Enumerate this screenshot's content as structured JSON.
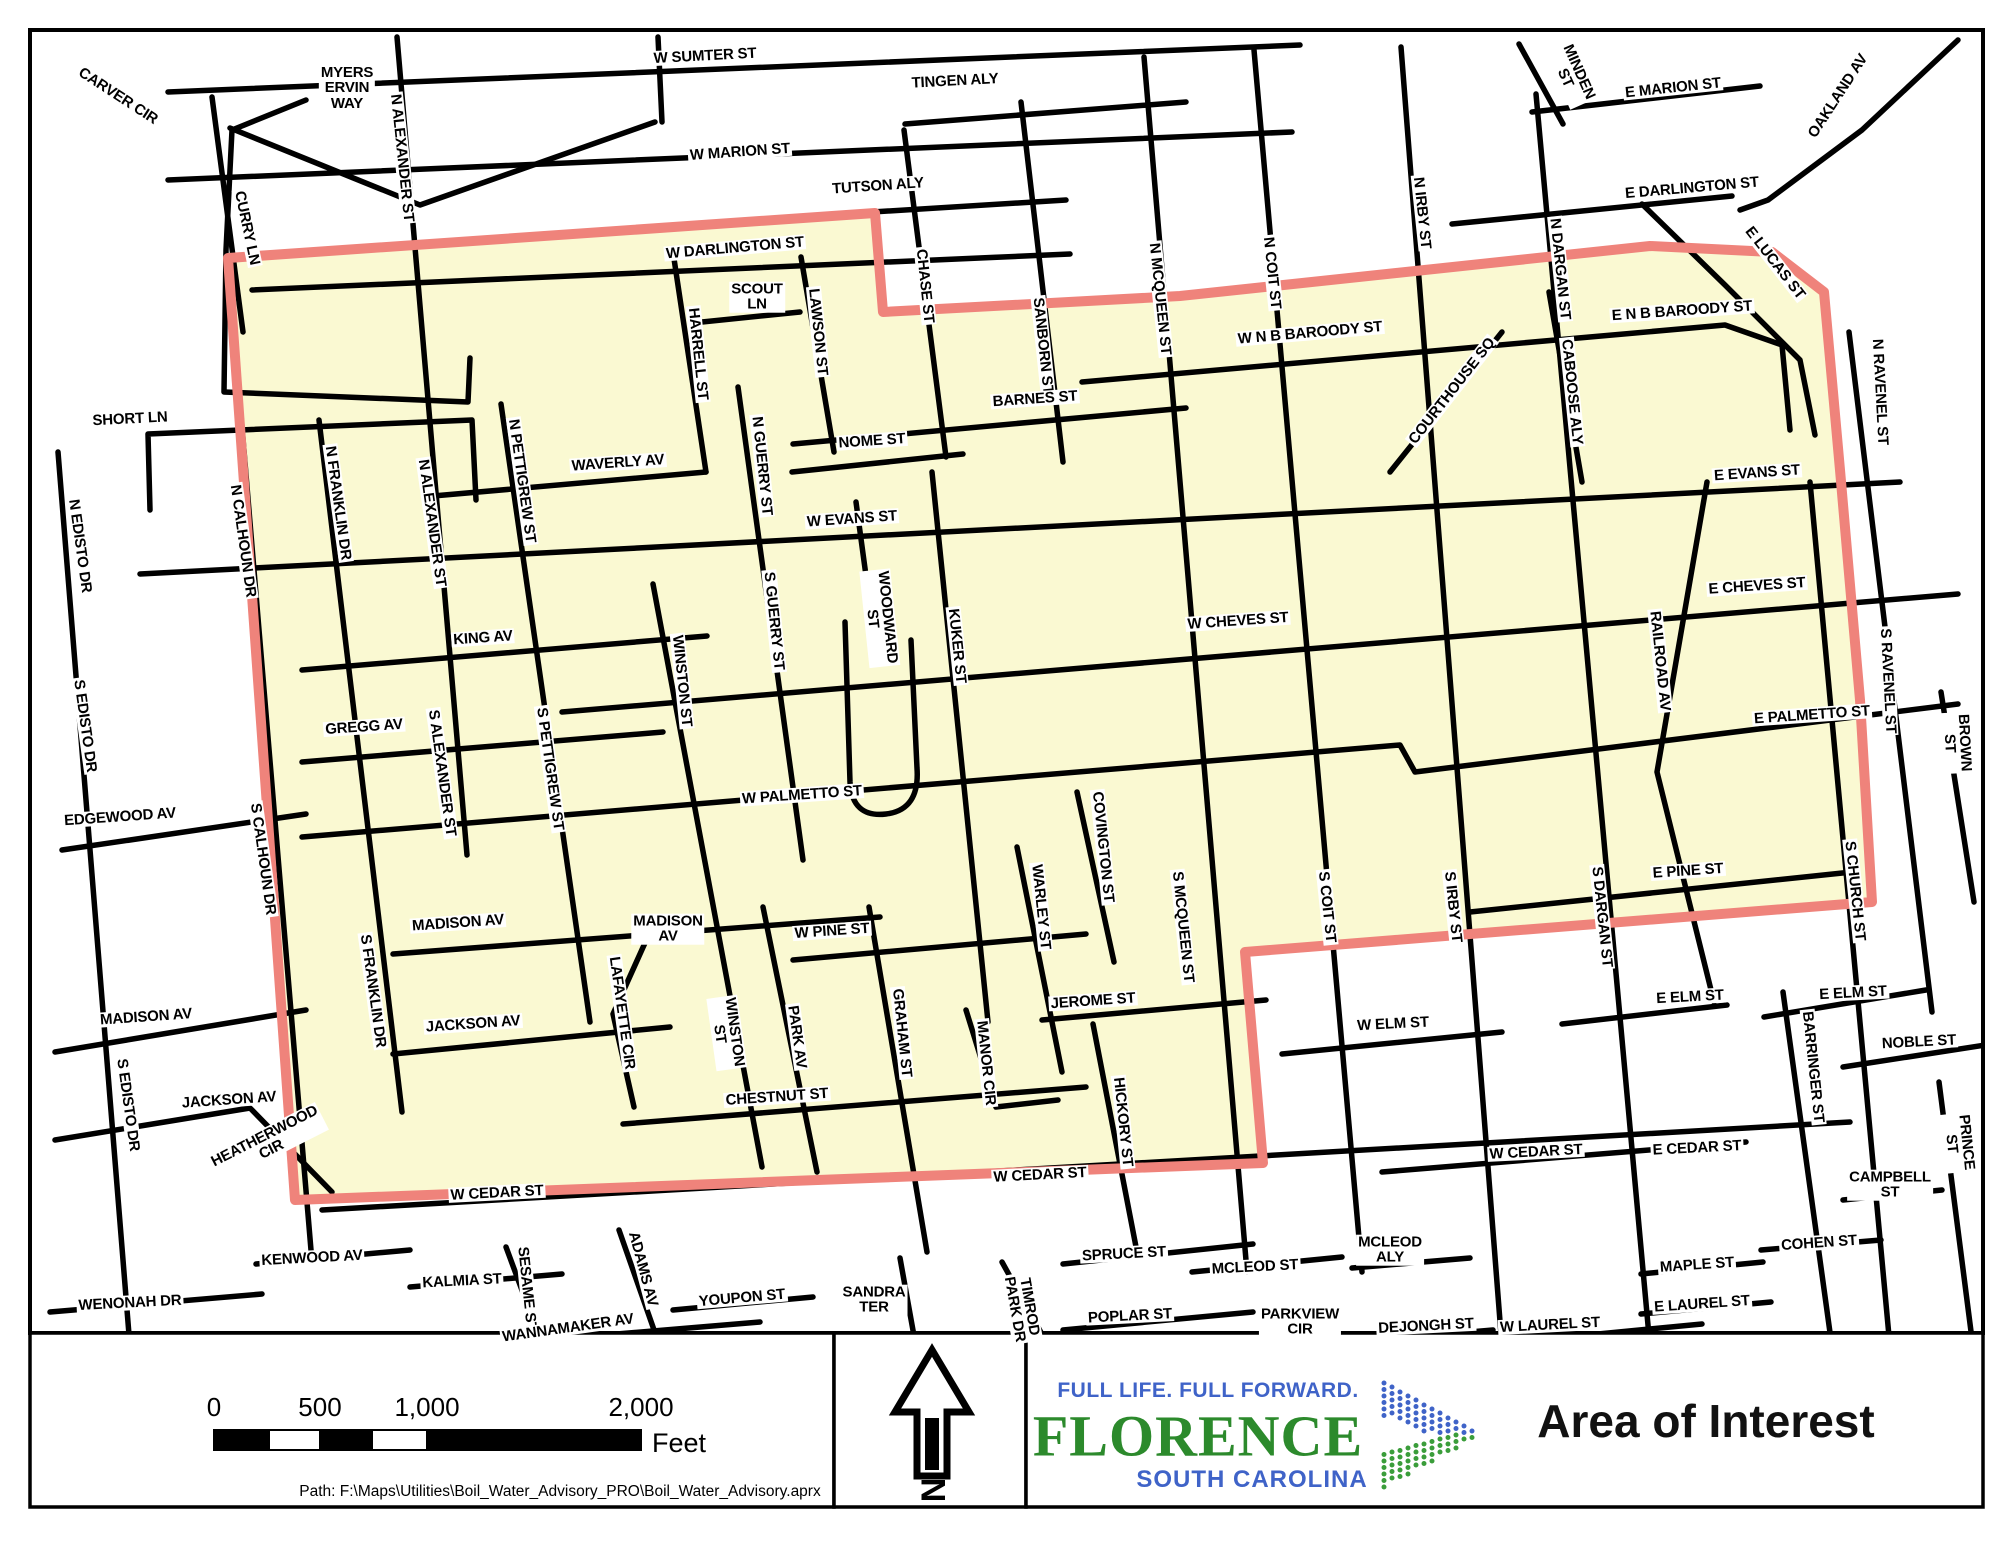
{
  "map": {
    "colors": {
      "road": "#000000",
      "area_fill": "#FAF9D2",
      "boundary": "#EF837B",
      "frame": "#000000"
    },
    "area_points": "228,258 875,213 883,312 1180,296 1650,246 1772,252 1824,292 1840,470 1860,700 1872,902 1245,952 1263,1163 295,1200",
    "roads": [
      {
        "p": "168,92 1300,45"
      },
      {
        "p": "168,180 1292,132"
      },
      {
        "p": "905,124 1186,102"
      },
      {
        "p": "792,217 1066,200"
      },
      {
        "p": "252,290 1070,254"
      },
      {
        "p": "1452,224 1732,196"
      },
      {
        "p": "1532,112 1760,86"
      },
      {
        "p": "1519,44 1563,124"
      },
      {
        "p": "1958,40 1862,130 1768,200 1740,210"
      },
      {
        "p": "1642,204 1725,285 1800,360 1815,435"
      },
      {
        "p": "1082,382 1725,325 1782,345 1790,430"
      },
      {
        "p": "793,444 1186,408"
      },
      {
        "p": "792,472 963,454"
      },
      {
        "p": "433,496 706,472"
      },
      {
        "p": "140,574 1900,482"
      },
      {
        "p": "302,670 707,636"
      },
      {
        "p": "562,712 1958,594"
      },
      {
        "p": "302,762 663,732"
      },
      {
        "p": "302,837 1400,745 1415,772 1958,704"
      },
      {
        "p": "393,954 880,917"
      },
      {
        "p": "393,1054 670,1027"
      },
      {
        "p": "793,960 1086,934"
      },
      {
        "p": "1042,1020 1266,1000"
      },
      {
        "p": "623,1124 1086,1087"
      },
      {
        "p": "322,1210 1850,1122"
      },
      {
        "p": "1282,1054 1502,1032"
      },
      {
        "p": "1562,1024 1727,1005"
      },
      {
        "p": "1764,1017 1926,990"
      },
      {
        "p": "1843,1067 1992,1044"
      },
      {
        "p": "1470,912 1852,872"
      },
      {
        "p": "1382,1172 1746,1142"
      },
      {
        "p": "62,850 306,814"
      },
      {
        "p": "55,1052 306,1010"
      },
      {
        "p": "55,1140 250,1108 332,1192"
      },
      {
        "p": "50,1312 262,1294"
      },
      {
        "p": "256,1264 410,1250"
      },
      {
        "p": "410,1287 562,1274"
      },
      {
        "p": "462,1347 760,1322"
      },
      {
        "p": "673,1310 813,1297"
      },
      {
        "p": "1063,1264 1253,1244"
      },
      {
        "p": "1063,1330 1253,1312"
      },
      {
        "p": "1192,1272 1342,1257"
      },
      {
        "p": "1352,1268 1470,1258"
      },
      {
        "p": "1463,1347 1702,1324"
      },
      {
        "p": "1641,1314 1771,1302"
      },
      {
        "p": "1641,1274 1763,1262"
      },
      {
        "p": "1761,1250 1881,1240"
      },
      {
        "p": "1352,1342 1493,1330"
      },
      {
        "p": "1843,1200 1942,1190"
      },
      {
        "p": "702,322 800,312"
      },
      {
        "p": "397,37 467,855"
      },
      {
        "p": "658,37 662,122"
      },
      {
        "p": "230,128 420,205 655,122"
      },
      {
        "p": "212,97 243,332"
      },
      {
        "p": "228,260 312,1262"
      },
      {
        "p": "673,252 706,472"
      },
      {
        "p": "801,257 834,452"
      },
      {
        "p": "904,130 946,457"
      },
      {
        "p": "1021,102 1063,462"
      },
      {
        "p": "1144,57 1247,1272"
      },
      {
        "p": "1254,50 1362,1272"
      },
      {
        "p": "1401,47 1502,1347"
      },
      {
        "p": "1536,94 1650,1347"
      },
      {
        "p": "1549,292 1582,482"
      },
      {
        "p": "1390,472 1502,332"
      },
      {
        "p": "738,387 803,860"
      },
      {
        "p": "856,502 872,620"
      },
      {
        "p": "932,472 988,1022"
      },
      {
        "p": "653,584 762,1167"
      },
      {
        "p": "1077,792 1114,962"
      },
      {
        "p": "1017,847 1062,1072"
      },
      {
        "p": "1707,482 1657,772 1714,1002"
      },
      {
        "p": "1810,482 1890,1347"
      },
      {
        "p": "1849,332 1932,1012"
      },
      {
        "p": "1941,692 1974,902"
      },
      {
        "p": "1783,992 1832,1347"
      },
      {
        "p": "1939,1082 1973,1347"
      },
      {
        "p": "319,420 402,1112"
      },
      {
        "p": "501,404 590,1022"
      },
      {
        "p": "649,934 613,1014 634,1107"
      },
      {
        "p": "763,907 817,1172"
      },
      {
        "p": "869,907 927,1252"
      },
      {
        "p": "966,1010 996,1107 1058,1100"
      },
      {
        "p": "1093,1024 1137,1252"
      },
      {
        "p": "58,452 130,1347"
      },
      {
        "p": "619,1230 660,1347"
      },
      {
        "p": "506,1247 543,1347"
      },
      {
        "p": "1002,1262 1049,1347"
      },
      {
        "p": "900,1258 916,1347"
      },
      {
        "p": "150,510 148,434 472,420 476,500"
      },
      {
        "p": "306,100 232,130 226,250 224,392 468,402 470,358"
      },
      {
        "d": "M845,622 L850,782 Q852,818 886,814 Q920,810 917,768 L911,640"
      }
    ],
    "labels": [
      {
        "t": "CARVER CIR",
        "x": 118,
        "y": 96,
        "r": 33
      },
      {
        "t": "MYERS\nERVIN\nWAY",
        "x": 347,
        "y": 88
      },
      {
        "t": "W SUMTER ST",
        "x": 705,
        "y": 56,
        "r": -3
      },
      {
        "t": "TINGEN ALY",
        "x": 955,
        "y": 81,
        "r": -3
      },
      {
        "t": "W MARION ST",
        "x": 740,
        "y": 152,
        "r": -4
      },
      {
        "t": "TUTSON ALY",
        "x": 878,
        "y": 186,
        "r": -4
      },
      {
        "t": "N ALEXANDER ST",
        "x": 402,
        "y": 158,
        "r": 84
      },
      {
        "t": "CURRY LN",
        "x": 247,
        "y": 228,
        "r": 78
      },
      {
        "t": "MINDEN\nST",
        "x": 1572,
        "y": 75,
        "r": 66
      },
      {
        "t": "E MARION ST",
        "x": 1673,
        "y": 88,
        "r": -6
      },
      {
        "t": "OAKLAND AV",
        "x": 1838,
        "y": 96,
        "r": -57
      },
      {
        "t": "E DARLINGTON ST",
        "x": 1692,
        "y": 188,
        "r": -5
      },
      {
        "t": "E LUCAS ST",
        "x": 1775,
        "y": 263,
        "r": 52
      },
      {
        "t": "N RAVENEL ST",
        "x": 1880,
        "y": 392,
        "r": 87
      },
      {
        "t": "W DARLINGTON ST",
        "x": 735,
        "y": 248,
        "r": -5
      },
      {
        "t": "SCOUT\nLN",
        "x": 757,
        "y": 297
      },
      {
        "t": "CHASE ST",
        "x": 925,
        "y": 286,
        "r": 84
      },
      {
        "t": "LAWSON ST",
        "x": 818,
        "y": 332,
        "r": 84
      },
      {
        "t": "SANBORN ST",
        "x": 1043,
        "y": 346,
        "r": 84
      },
      {
        "t": "N MCQUEEN ST",
        "x": 1160,
        "y": 299,
        "r": 84
      },
      {
        "t": "N COIT ST",
        "x": 1272,
        "y": 273,
        "r": 84
      },
      {
        "t": "N IRBY ST",
        "x": 1422,
        "y": 213,
        "r": 84
      },
      {
        "t": "W N B BAROODY ST",
        "x": 1310,
        "y": 333,
        "r": -5
      },
      {
        "t": "E N B BAROODY ST",
        "x": 1682,
        "y": 311,
        "r": -4
      },
      {
        "t": "COURTHOUSE SQ",
        "x": 1452,
        "y": 391,
        "r": -52
      },
      {
        "t": "N DARGAN ST",
        "x": 1560,
        "y": 269,
        "r": 84
      },
      {
        "t": "CABOOSE ALY",
        "x": 1572,
        "y": 392,
        "r": 84
      },
      {
        "t": "BARNES ST",
        "x": 1035,
        "y": 399,
        "r": -4
      },
      {
        "t": "HARRELL ST",
        "x": 698,
        "y": 354,
        "r": 84
      },
      {
        "t": "NOME ST",
        "x": 872,
        "y": 441,
        "r": -4
      },
      {
        "t": "N GUERRY ST",
        "x": 762,
        "y": 466,
        "r": 84
      },
      {
        "t": "WAVERLY AV",
        "x": 618,
        "y": 463,
        "r": -4
      },
      {
        "t": "W EVANS ST",
        "x": 852,
        "y": 519,
        "r": -4
      },
      {
        "t": "E EVANS ST",
        "x": 1757,
        "y": 473,
        "r": -4
      },
      {
        "t": "SHORT LN",
        "x": 130,
        "y": 419,
        "r": -3
      },
      {
        "t": "N EDISTO DR",
        "x": 80,
        "y": 546,
        "r": 82
      },
      {
        "t": "N CALHOUN DR",
        "x": 243,
        "y": 541,
        "r": 82
      },
      {
        "t": "N FRANKLIN DR",
        "x": 338,
        "y": 503,
        "r": 82
      },
      {
        "t": "N ALEXANDER ST",
        "x": 432,
        "y": 523,
        "r": 82
      },
      {
        "t": "N PETTIGREW ST",
        "x": 522,
        "y": 481,
        "r": 82
      },
      {
        "t": "S GUERRY ST",
        "x": 774,
        "y": 621,
        "r": 84
      },
      {
        "t": "WOODWARD\nST",
        "x": 880,
        "y": 618,
        "r": 84
      },
      {
        "t": "KUKER ST",
        "x": 957,
        "y": 646,
        "r": 84
      },
      {
        "t": "W CHEVES ST",
        "x": 1238,
        "y": 621,
        "r": -4
      },
      {
        "t": "E CHEVES ST",
        "x": 1757,
        "y": 586,
        "r": -4
      },
      {
        "t": "KING AV",
        "x": 483,
        "y": 638,
        "r": -4
      },
      {
        "t": "WINSTON ST",
        "x": 682,
        "y": 681,
        "r": 84
      },
      {
        "t": "RAILROAD AV",
        "x": 1660,
        "y": 661,
        "r": 84
      },
      {
        "t": "S RAVENEL ST",
        "x": 1888,
        "y": 681,
        "r": 87
      },
      {
        "t": "BROWN ST",
        "x": 1957,
        "y": 743,
        "r": 87
      },
      {
        "t": "GREGG AV",
        "x": 364,
        "y": 727,
        "r": -4
      },
      {
        "t": "S ALEXANDER ST",
        "x": 442,
        "y": 773,
        "r": 82
      },
      {
        "t": "S PETTIGREW ST",
        "x": 550,
        "y": 769,
        "r": 82
      },
      {
        "t": "S EDISTO DR",
        "x": 85,
        "y": 726,
        "r": 82
      },
      {
        "t": "S CALHOUN DR",
        "x": 263,
        "y": 859,
        "r": 82
      },
      {
        "t": "EDGEWOOD AV",
        "x": 120,
        "y": 817,
        "r": -4
      },
      {
        "t": "W PALMETTO ST",
        "x": 802,
        "y": 795,
        "r": -4
      },
      {
        "t": "E PALMETTO ST",
        "x": 1812,
        "y": 715,
        "r": -4
      },
      {
        "t": "COVINGTON ST",
        "x": 1103,
        "y": 847,
        "r": 84
      },
      {
        "t": "WARLEY ST",
        "x": 1041,
        "y": 907,
        "r": 84
      },
      {
        "t": "S MCQUEEN ST",
        "x": 1183,
        "y": 927,
        "r": 84
      },
      {
        "t": "S COIT ST",
        "x": 1327,
        "y": 907,
        "r": 84
      },
      {
        "t": "S IRBY ST",
        "x": 1453,
        "y": 907,
        "r": 84
      },
      {
        "t": "S DARGAN ST",
        "x": 1602,
        "y": 917,
        "r": 84
      },
      {
        "t": "E PINE ST",
        "x": 1688,
        "y": 871,
        "r": -4
      },
      {
        "t": "S CHURCH ST",
        "x": 1855,
        "y": 891,
        "r": 84
      },
      {
        "t": "MADISON AV",
        "x": 458,
        "y": 923,
        "r": -4
      },
      {
        "t": "MADISON\nAV",
        "x": 668,
        "y": 929
      },
      {
        "t": "W PINE ST",
        "x": 832,
        "y": 931,
        "r": -4
      },
      {
        "t": "GRAHAM ST",
        "x": 902,
        "y": 1033,
        "r": 84
      },
      {
        "t": "MANOR CIR",
        "x": 986,
        "y": 1063,
        "r": 84
      },
      {
        "t": "JEROME ST",
        "x": 1093,
        "y": 1001,
        "r": -4
      },
      {
        "t": "LAFAYETTE CIR",
        "x": 622,
        "y": 1013,
        "r": 82
      },
      {
        "t": "WINSTON\nST",
        "x": 727,
        "y": 1033,
        "r": 82
      },
      {
        "t": "PARK AV",
        "x": 797,
        "y": 1037,
        "r": 82
      },
      {
        "t": "JACKSON AV",
        "x": 473,
        "y": 1024,
        "r": -4
      },
      {
        "t": "S FRANKLIN DR",
        "x": 373,
        "y": 991,
        "r": 82
      },
      {
        "t": "MADISON AV",
        "x": 146,
        "y": 1017,
        "r": -4
      },
      {
        "t": "JACKSON AV",
        "x": 229,
        "y": 1100,
        "r": -4
      },
      {
        "t": "S EDISTO DR",
        "x": 128,
        "y": 1105,
        "r": 82
      },
      {
        "t": "HEATHERWOOD\nCIR",
        "x": 268,
        "y": 1143,
        "r": -27
      },
      {
        "t": "CHESTNUT ST",
        "x": 777,
        "y": 1097,
        "r": -4
      },
      {
        "t": "HICKORY ST",
        "x": 1123,
        "y": 1122,
        "r": 84
      },
      {
        "t": "W CEDAR ST",
        "x": 497,
        "y": 1193,
        "r": -3
      },
      {
        "t": "W CEDAR ST",
        "x": 1040,
        "y": 1175,
        "r": -3
      },
      {
        "t": "W ELM ST",
        "x": 1393,
        "y": 1024,
        "r": -3
      },
      {
        "t": "E ELM ST",
        "x": 1690,
        "y": 997,
        "r": -3
      },
      {
        "t": "E ELM ST",
        "x": 1853,
        "y": 993,
        "r": -3
      },
      {
        "t": "BARRINGER ST",
        "x": 1813,
        "y": 1067,
        "r": 84
      },
      {
        "t": "NOBLE ST",
        "x": 1919,
        "y": 1042,
        "r": -3
      },
      {
        "t": "W CEDAR ST",
        "x": 1536,
        "y": 1152,
        "r": -3
      },
      {
        "t": "E CEDAR ST",
        "x": 1697,
        "y": 1148,
        "r": -3
      },
      {
        "t": "CAMPBELL\nST",
        "x": 1890,
        "y": 1185
      },
      {
        "t": "PRINCE ST",
        "x": 1959,
        "y": 1143,
        "r": 84
      },
      {
        "t": "COHEN ST",
        "x": 1819,
        "y": 1243,
        "r": -4
      },
      {
        "t": "MAPLE ST",
        "x": 1697,
        "y": 1265,
        "r": -4
      },
      {
        "t": "E LAUREL ST",
        "x": 1702,
        "y": 1304,
        "r": -4
      },
      {
        "t": "W LAUREL ST",
        "x": 1550,
        "y": 1325,
        "r": -3
      },
      {
        "t": "DEJONGH ST",
        "x": 1426,
        "y": 1326,
        "r": -3
      },
      {
        "t": "MCLEOD ST",
        "x": 1255,
        "y": 1267,
        "r": -3
      },
      {
        "t": "MCLEOD\nALY",
        "x": 1390,
        "y": 1250
      },
      {
        "t": "PARKVIEW\nCIR",
        "x": 1300,
        "y": 1322
      },
      {
        "t": "POPLAR ST",
        "x": 1130,
        "y": 1316,
        "r": -3
      },
      {
        "t": "SPRUCE ST",
        "x": 1124,
        "y": 1254,
        "r": -3
      },
      {
        "t": "TIMROD\nPARK DR",
        "x": 1022,
        "y": 1308,
        "r": 80
      },
      {
        "t": "SANDRA\nTER",
        "x": 874,
        "y": 1300
      },
      {
        "t": "YOUPON ST",
        "x": 742,
        "y": 1298,
        "r": -5
      },
      {
        "t": "ADAMS AV",
        "x": 643,
        "y": 1269,
        "r": 75
      },
      {
        "t": "SESAME ST",
        "x": 527,
        "y": 1289,
        "r": 84
      },
      {
        "t": "KALMIA ST",
        "x": 462,
        "y": 1281,
        "r": -3
      },
      {
        "t": "KENWOOD AV",
        "x": 312,
        "y": 1258,
        "r": -3
      },
      {
        "t": "WANNAMAKER AV",
        "x": 568,
        "y": 1328,
        "r": -8
      },
      {
        "t": "WENONAH DR",
        "x": 130,
        "y": 1303,
        "r": -3
      }
    ]
  },
  "footer": {
    "scalebar": {
      "ticks": [
        {
          "label": "0",
          "x": 214
        },
        {
          "label": "500",
          "x": 320
        },
        {
          "label": "1,000",
          "x": 427
        },
        {
          "label": "2,000",
          "x": 641
        }
      ],
      "unit": "Feet",
      "bar": {
        "x": 214,
        "y": 1430,
        "h": 20,
        "segments": [
          {
            "w": 55,
            "c": "#000000"
          },
          {
            "w": 51,
            "c": "#ffffff"
          },
          {
            "w": 52,
            "c": "#000000"
          },
          {
            "w": 55,
            "c": "#ffffff"
          },
          {
            "w": 214,
            "c": "#000000"
          }
        ]
      },
      "path_text": "Path: F:\\Maps\\Utilities\\Boil_Water_Advisory_PRO\\Boil_Water_Advisory.aprx"
    },
    "north": {
      "label": "N"
    },
    "logo": {
      "tagline": "FULL LIFE. FULL FORWARD.",
      "name": "FLORENCE",
      "subtitle": "SOUTH CAROLINA",
      "tagline_color": "#3f63c8",
      "name_color": "#2c8a2c",
      "subtitle_color": "#3f63c8",
      "chevron_blue": "#3f63c8",
      "chevron_green": "#3a9d3a"
    },
    "title": "Area of Interest"
  }
}
